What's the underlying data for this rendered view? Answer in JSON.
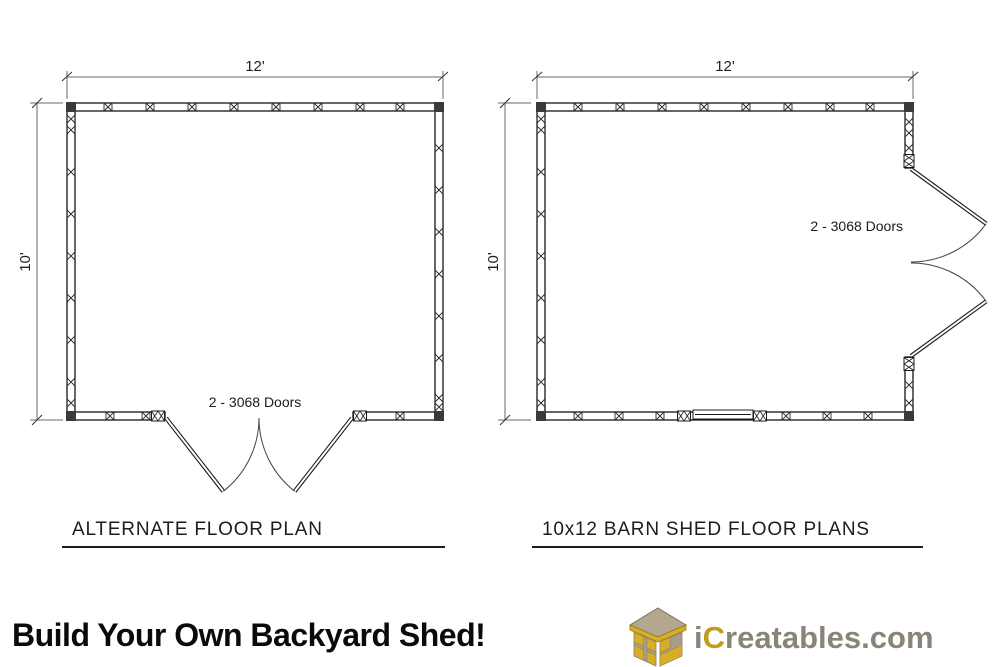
{
  "drawing": {
    "left_plan": {
      "caption": "ALTERNATE FLOOR PLAN",
      "width_label": "12'",
      "height_label": "10'",
      "door_label": "2 - 3068 Doors"
    },
    "right_plan": {
      "caption": "10x12 BARN SHED FLOOR PLANS",
      "width_label": "12'",
      "height_label": "10'",
      "door_label": "2 - 3068 Doors"
    }
  },
  "banner": {
    "headline": "Build Your Own Backyard Shed!",
    "brand": {
      "prefix": "i",
      "accent": "C",
      "rest": "reatables.com"
    },
    "logo_icon": "isometric-shed-icon",
    "colors": {
      "headline_text": "#0a0a0a",
      "brand_text": "#8a8478",
      "brand_accent": "#c29b21",
      "logo_yellow": "#d9ae27",
      "logo_tan": "#b3a78d",
      "linework": "#1c1c1c"
    }
  }
}
